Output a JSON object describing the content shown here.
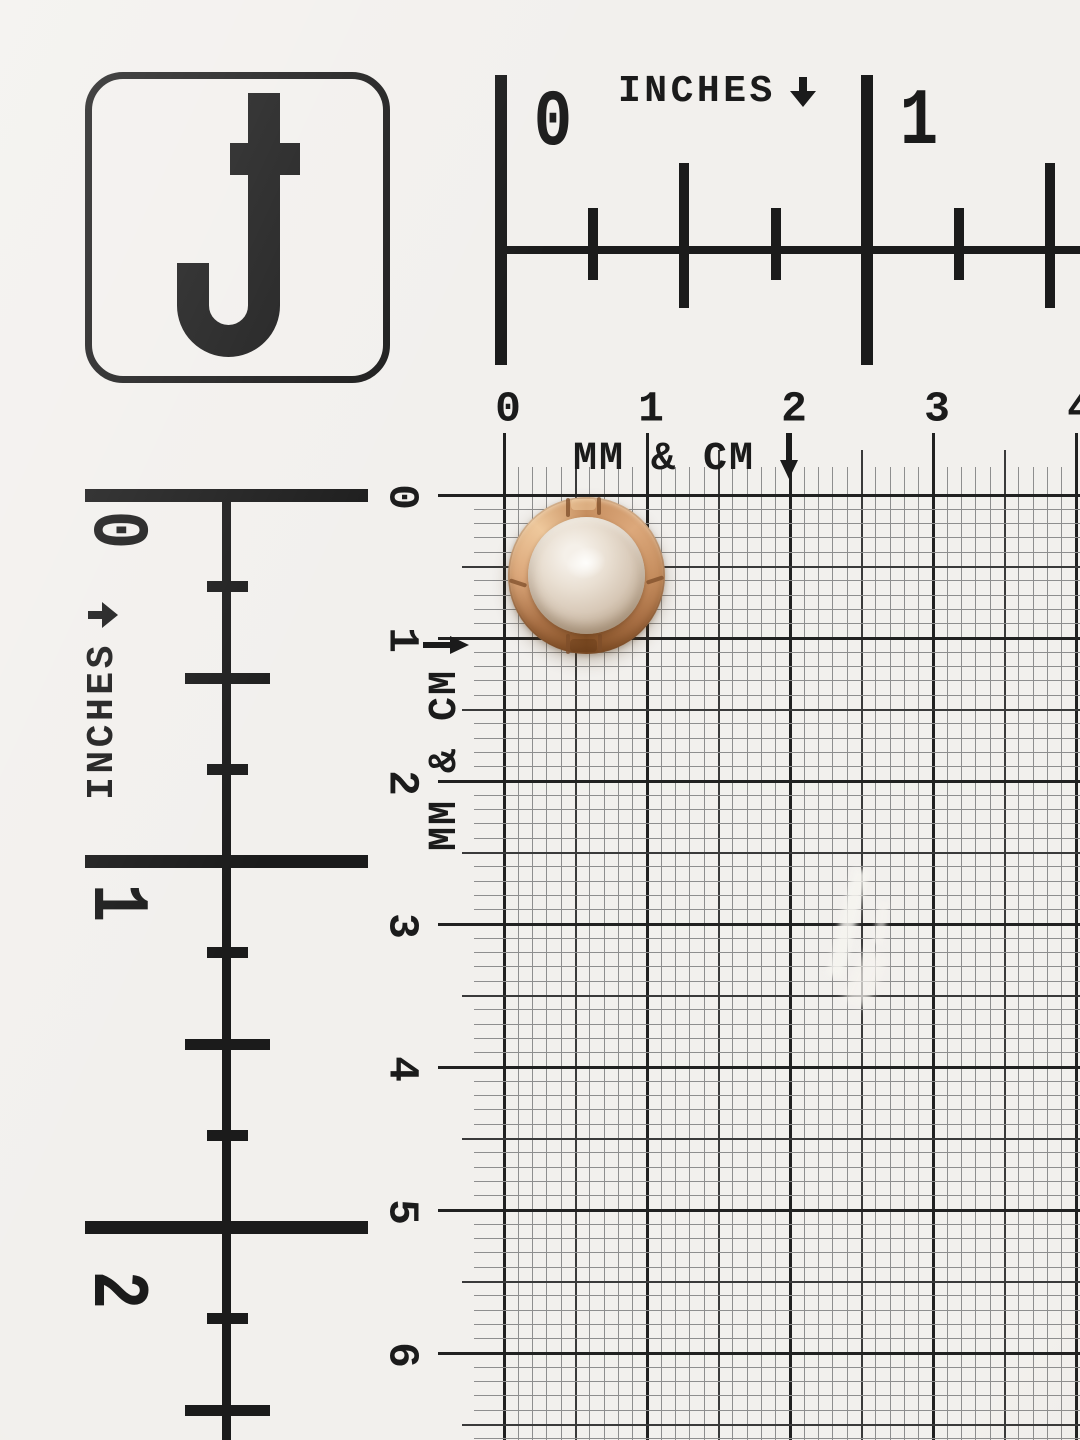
{
  "logo": {
    "letter": "J"
  },
  "rulers": {
    "unit_label": "INCHES",
    "top_numbers": [
      "0",
      "1"
    ],
    "left_numbers": [
      "0",
      "1",
      "2"
    ]
  },
  "grid": {
    "unit_label": "MM & CM",
    "top_numbers": [
      "0",
      "1",
      "2",
      "3",
      "4"
    ],
    "left_numbers": [
      "0",
      "1",
      "2",
      "3",
      "4",
      "5",
      "6"
    ]
  },
  "specimen": {
    "name": "pearl button with gold segmented rim",
    "position_on_grid_cm": "centered near 0.5-1 cm"
  },
  "colors": {
    "paper": "#f2f0ed",
    "ink": "#1b1b1b",
    "grid_thin": "#8e8e8e",
    "grid_medium": "#3a3a3a",
    "grid_major": "#212121",
    "gold_highlight": "#eec89c",
    "gold_light": "#dca87b",
    "gold_mid": "#c68e5f",
    "gold_deep": "#aa7146",
    "gold_shadow": "#835026",
    "gold_seam": "#7d4e2a",
    "pearl_highlight": "#f5f0e9",
    "pearl_light": "#e9dfd2",
    "pearl_mid": "#d8c9b8",
    "pearl_deep": "#c3b09a",
    "pearl_shadow": "#a8927a"
  }
}
